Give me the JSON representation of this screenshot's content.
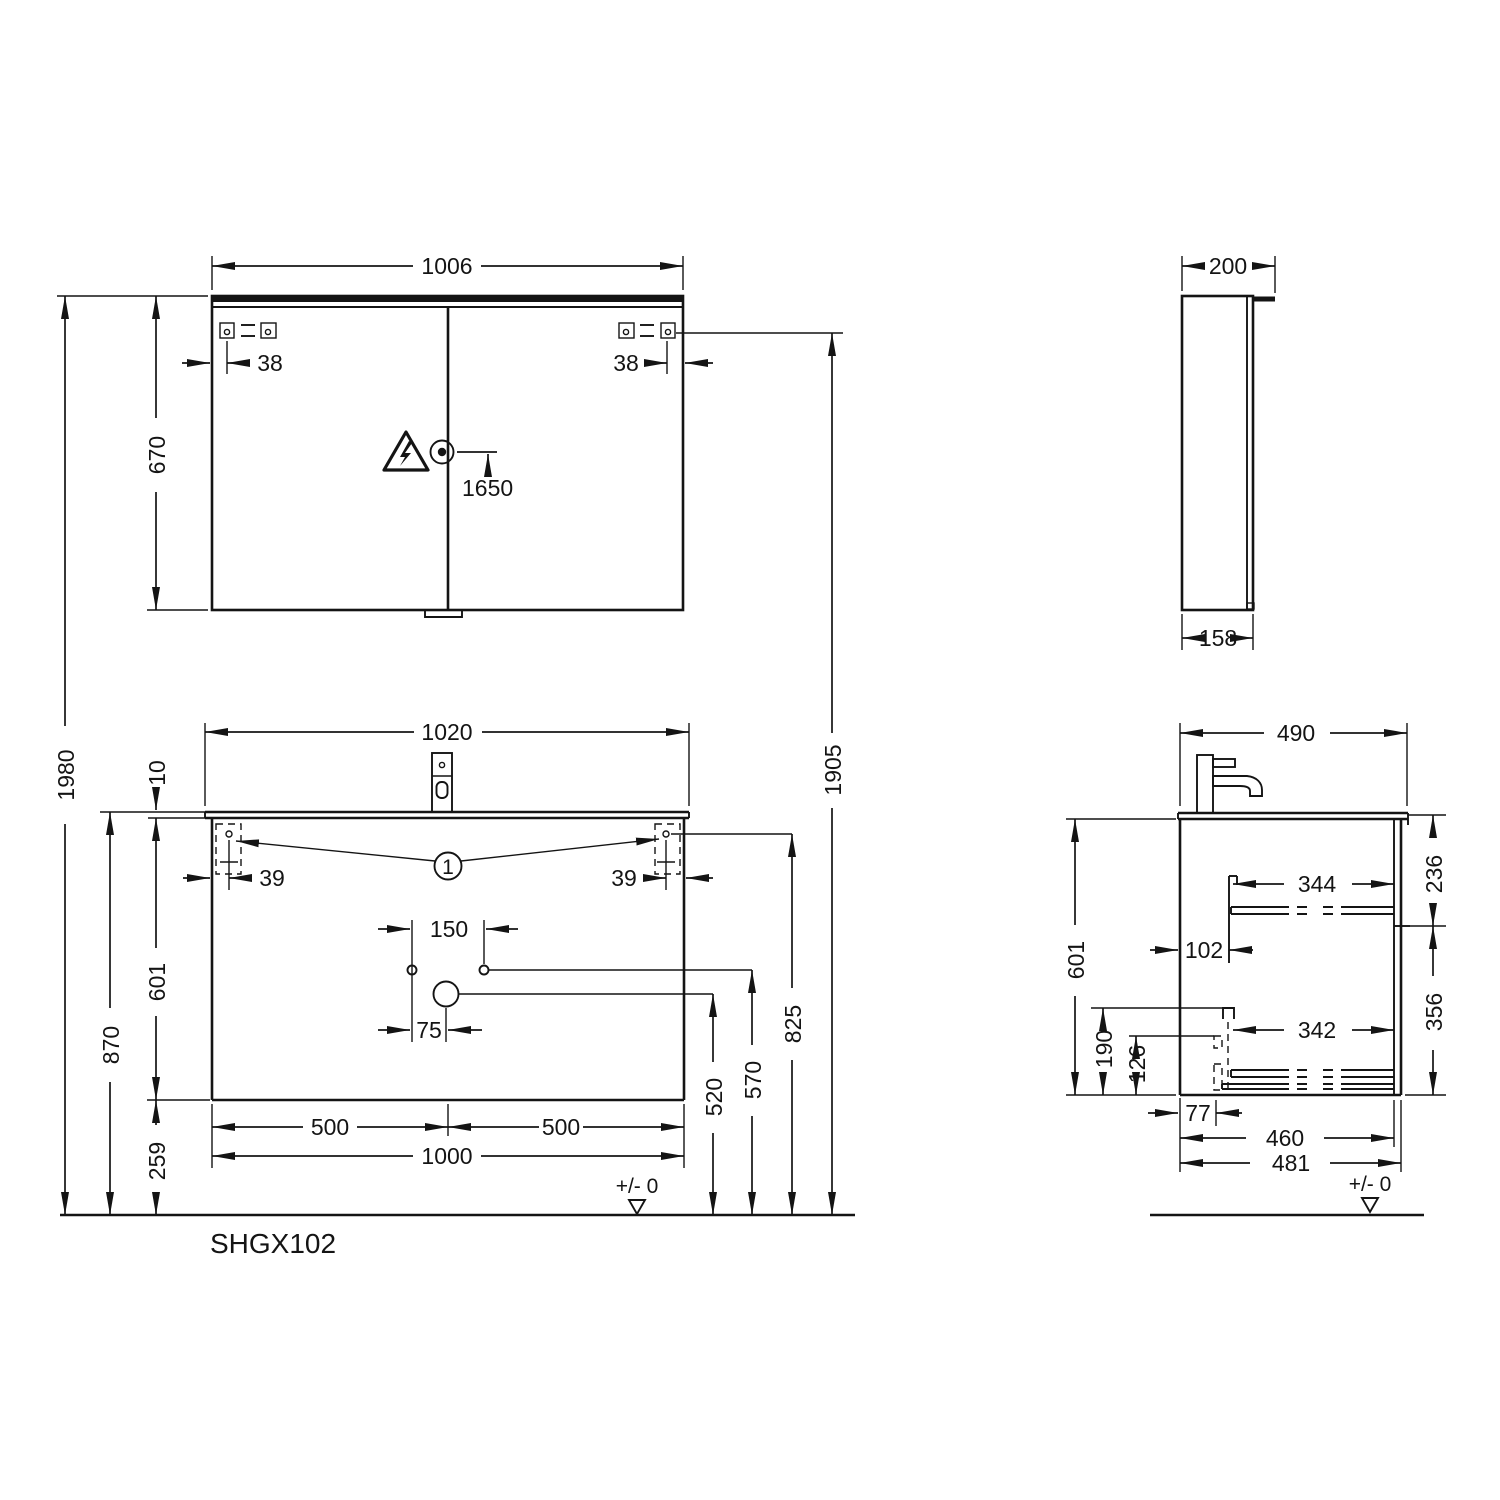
{
  "sheet": {
    "product_code": "SHGX102",
    "datum_label": "+/- 0",
    "callout_label": "1",
    "line_color": "#141414",
    "background_color": "#ffffff"
  },
  "mirror_front": {
    "width": "1006",
    "height": "670",
    "hinge_offset_left": "38",
    "hinge_offset_right": "38",
    "socket_height": "1650"
  },
  "mirror_side": {
    "depth": "200",
    "body_depth": "158"
  },
  "vanity_front": {
    "overall_height": "1980",
    "height_to_basin": "870",
    "basin_thickness": "10",
    "cabinet_height": "601",
    "bottom_clearance": "259",
    "basin_width": "1020",
    "cabinet_width": "1000",
    "half_width_left": "500",
    "half_width_right": "500",
    "mount_offset_left": "39",
    "mount_offset_right": "39",
    "tap_hole_spacing": "150",
    "waste_offset": "75",
    "waste_height": "520",
    "supply_height": "570",
    "bracket_height": "825",
    "mirror_bracket_height": "1905"
  },
  "vanity_side": {
    "depth": "490",
    "cabinet_height": "601",
    "upper_drawer_zone": "236",
    "lower_drawer_zone": "356",
    "upper_rail_length": "344",
    "rail_setback": "102",
    "lower_rail_length": "342",
    "trap_clearance_height": "190",
    "trap_height": "126",
    "rear_clearance": "77",
    "cabinet_depth": "460",
    "overall_depth": "481"
  }
}
